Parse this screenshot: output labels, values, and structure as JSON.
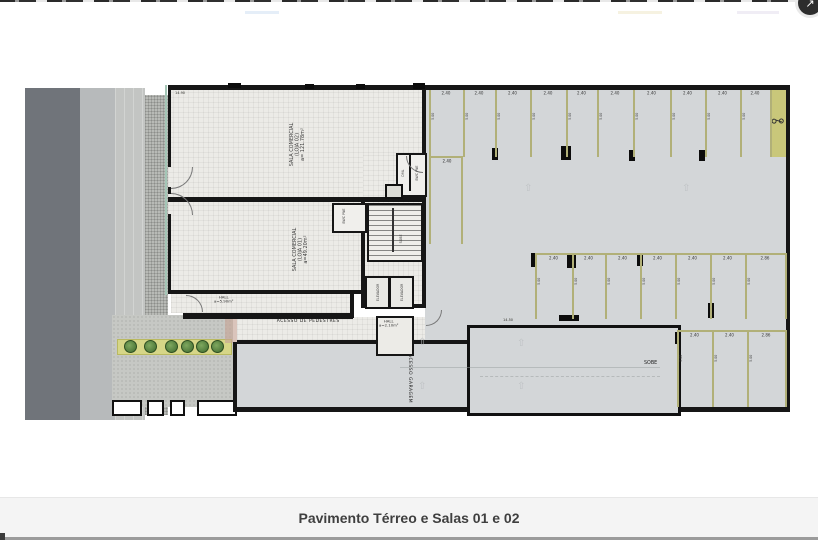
{
  "page": {
    "caption": "Pavimento Térreo e Salas 01 e 02"
  },
  "header": {
    "corner_button_icon": "↗"
  },
  "plan": {
    "rooms": {
      "loja02_label": "SALA COMERCIAL\n(LOJA 02)\na= 121.78m²",
      "loja01_label": "SALA COMERCIAL\n(LOJA 01)\na=49.20m²",
      "hall_main_label": "HALL\na=5.90m²",
      "hall_garage_label": "HALL\na=2.10m²",
      "bwc_label": "BWC PNE",
      "dml_label": "DML",
      "elevator_label": "ELEVADOR",
      "sobe_label": "SOBE"
    },
    "labels": {
      "pedestrian_access": "ACESSO DE PEDESTRES",
      "garage_access": "ACESSO GARAGEM"
    },
    "dimensions": {
      "overall_width": "14.90",
      "ramp_length": "14.50",
      "stall_width": "2.40",
      "stall_depth": "5.00",
      "stall_wide": "2.86"
    },
    "colors": {
      "wall": "#161616",
      "garage_floor": "#d3d6d8",
      "room_floor": "#ecebe7",
      "stall_line": "#b1b078",
      "street": "#70747a",
      "planting": "#d6d687",
      "caption_bg": "#f4f4f4"
    }
  }
}
